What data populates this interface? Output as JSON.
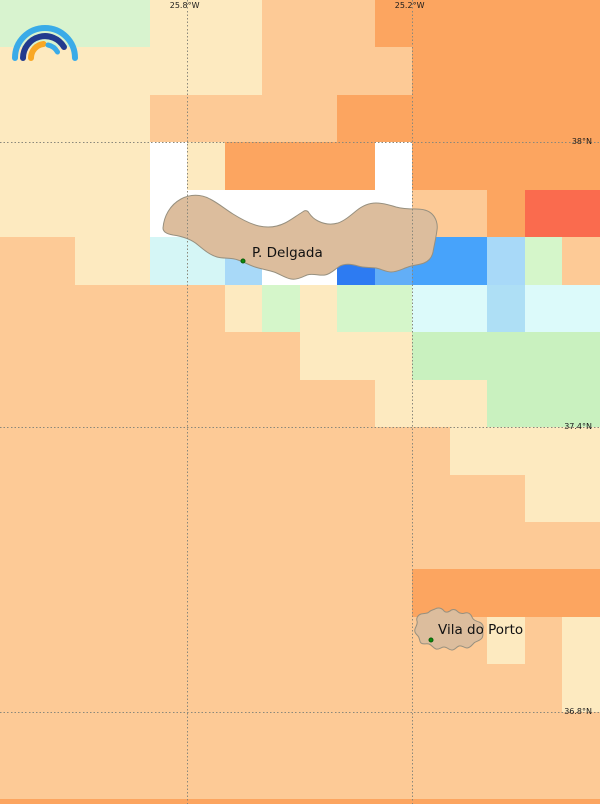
{
  "map": {
    "width": 600,
    "height": 804,
    "palette": {
      "cream": "#fdeac0",
      "peach": "#fdca96",
      "orange": "#fca560",
      "red": "#fa6b4e",
      "green": "#d8f3cf",
      "palegreen": "#d5f6ca",
      "green2": "#c9f1bf",
      "vlcyan": "#dcfafa",
      "lcyan": "#d5f6f6",
      "pblue": "#aedff5",
      "lblue": "#a8d9f8",
      "sblue": "#62aef7",
      "bblue": "#47a3fb",
      "rblue": "#2d7bf2",
      "white": "#ffffff",
      "island_fill": "#dcbd9d",
      "island_stroke": "#97907f"
    },
    "cells": [
      {
        "x": 0,
        "y": 0,
        "w": 600,
        "h": 804,
        "c": "peach"
      },
      {
        "x": 0,
        "y": 0,
        "w": 150,
        "h": 47,
        "c": "green"
      },
      {
        "x": 150,
        "y": 0,
        "w": 112,
        "h": 47,
        "c": "cream"
      },
      {
        "x": 0,
        "y": 47,
        "w": 262,
        "h": 48,
        "c": "cream"
      },
      {
        "x": 0,
        "y": 95,
        "w": 150,
        "h": 47,
        "c": "cream"
      },
      {
        "x": 375,
        "y": 0,
        "w": 37,
        "h": 47,
        "c": "orange"
      },
      {
        "x": 412,
        "y": 0,
        "w": 188,
        "h": 142,
        "c": "orange"
      },
      {
        "x": 337,
        "y": 95,
        "w": 75,
        "h": 47,
        "c": "orange"
      },
      {
        "x": 0,
        "y": 142,
        "w": 150,
        "h": 95,
        "c": "cream"
      },
      {
        "x": 150,
        "y": 142,
        "w": 37,
        "h": 95,
        "c": "white"
      },
      {
        "x": 187,
        "y": 142,
        "w": 38,
        "h": 48,
        "c": "cream"
      },
      {
        "x": 225,
        "y": 142,
        "w": 150,
        "h": 48,
        "c": "orange"
      },
      {
        "x": 375,
        "y": 142,
        "w": 37,
        "h": 48,
        "c": "white"
      },
      {
        "x": 412,
        "y": 142,
        "w": 188,
        "h": 48,
        "c": "orange"
      },
      {
        "x": 187,
        "y": 190,
        "w": 225,
        "h": 47,
        "c": "white"
      },
      {
        "x": 487,
        "y": 190,
        "w": 38,
        "h": 47,
        "c": "orange"
      },
      {
        "x": 525,
        "y": 190,
        "w": 75,
        "h": 47,
        "c": "red"
      },
      {
        "x": 75,
        "y": 237,
        "w": 75,
        "h": 48,
        "c": "cream"
      },
      {
        "x": 150,
        "y": 237,
        "w": 75,
        "h": 48,
        "c": "lcyan"
      },
      {
        "x": 225,
        "y": 237,
        "w": 37,
        "h": 48,
        "c": "lblue"
      },
      {
        "x": 262,
        "y": 237,
        "w": 75,
        "h": 48,
        "c": "white"
      },
      {
        "x": 337,
        "y": 237,
        "w": 38,
        "h": 48,
        "c": "rblue"
      },
      {
        "x": 375,
        "y": 237,
        "w": 37,
        "h": 48,
        "c": "sblue"
      },
      {
        "x": 412,
        "y": 237,
        "w": 75,
        "h": 48,
        "c": "bblue"
      },
      {
        "x": 487,
        "y": 237,
        "w": 38,
        "h": 48,
        "c": "lblue"
      },
      {
        "x": 525,
        "y": 237,
        "w": 37,
        "h": 48,
        "c": "palegreen"
      },
      {
        "x": 225,
        "y": 285,
        "w": 37,
        "h": 47,
        "c": "cream"
      },
      {
        "x": 262,
        "y": 285,
        "w": 38,
        "h": 47,
        "c": "palegreen"
      },
      {
        "x": 300,
        "y": 285,
        "w": 37,
        "h": 47,
        "c": "cream"
      },
      {
        "x": 337,
        "y": 285,
        "w": 75,
        "h": 47,
        "c": "palegreen"
      },
      {
        "x": 412,
        "y": 285,
        "w": 75,
        "h": 47,
        "c": "vlcyan"
      },
      {
        "x": 487,
        "y": 285,
        "w": 38,
        "h": 47,
        "c": "pblue"
      },
      {
        "x": 525,
        "y": 285,
        "w": 75,
        "h": 47,
        "c": "vlcyan"
      },
      {
        "x": 300,
        "y": 332,
        "w": 112,
        "h": 48,
        "c": "cream"
      },
      {
        "x": 412,
        "y": 332,
        "w": 188,
        "h": 48,
        "c": "green2"
      },
      {
        "x": 375,
        "y": 380,
        "w": 112,
        "h": 47,
        "c": "cream"
      },
      {
        "x": 487,
        "y": 380,
        "w": 113,
        "h": 47,
        "c": "green2"
      },
      {
        "x": 450,
        "y": 427,
        "w": 150,
        "h": 48,
        "c": "cream"
      },
      {
        "x": 525,
        "y": 475,
        "w": 75,
        "h": 47,
        "c": "cream"
      },
      {
        "x": 412,
        "y": 569,
        "w": 188,
        "h": 48,
        "c": "orange"
      },
      {
        "x": 487,
        "y": 617,
        "w": 38,
        "h": 47,
        "c": "cream"
      },
      {
        "x": 562,
        "y": 617,
        "w": 38,
        "h": 95,
        "c": "cream"
      },
      {
        "x": 0,
        "y": 799,
        "w": 600,
        "h": 5,
        "c": "orange"
      }
    ],
    "graticule": {
      "color": "#8a887b",
      "verticals": [
        {
          "x": 187,
          "label": "25.8°W"
        },
        {
          "x": 412,
          "label": "25.2°W"
        }
      ],
      "horizontals": [
        {
          "y": 142,
          "label": "38°N"
        },
        {
          "y": 427,
          "label": "37.4°N"
        },
        {
          "y": 712,
          "label": "36.8°N"
        }
      ]
    },
    "islands": {
      "sao_miguel": "M 163 228 C 164 216 170 205 181 199 C 190 194 201 194 210 199 C 218 203 225 209 233 214 C 241 219 250 224 259 226 C 268 228 277 227 285 223 C 291 220 296 216 301 213 L 304 211 C 306 210 308 211 309 213 C 311 216 314 219 318 221 C 324 224 331 225 338 223 C 344 221 350 216 356 211 C 362 206 369 203 376 203 C 383 203 390 205 396 207 C 403 209 410 209 416 209 C 422 209 428 210 432 214 C 436 218 438 224 437 230 C 436 238 434 246 433 252 C 432 257 429 261 424 263 C 419 265 413 265 408 267 C 402 269 397 272 391 272 C 386 272 381 269 376 268 C 370 267 364 268 358 266 C 352 264 346 263 340 266 C 335 269 331 274 325 275 C 319 276 313 273 307 275 C 302 277 297 280 291 279 C 285 278 280 274 274 272 C 268 270 261 269 255 267 C 249 265 244 262 238 260 C 231 257 224 259 217 257 C 210 255 204 250 198 245 C 190 238 180 236 173 235 C 167 234 163 232 163 228 Z",
      "santa_maria": "M 435 609 C 438 607 442 608 444 611 C 446 613 448 612 450 611 C 452 609 455 609 457 611 C 459 613 462 614 465 613 C 468 612 471 614 472 617 C 473 620 476 621 479 622 C 482 623 484 626 483 629 C 482 632 484 635 482 638 C 480 641 476 641 474 643 C 472 645 470 648 467 648 C 464 648 462 645 459 646 C 456 647 455 650 452 650 C 449 650 447 647 444 647 C 441 647 439 650 436 649 C 433 648 432 645 429 644 C 426 643 423 645 421 643 C 419 641 420 638 418 636 C 416 634 414 632 415 629 C 416 626 418 624 417 621 C 416 618 418 615 421 614 C 424 613 427 614 429 612 C 431 610 433 610 435 609 Z"
    },
    "cities": [
      {
        "name": "P. Delgada",
        "dot_x": 243,
        "dot_y": 261,
        "text_x": 252,
        "text_y": 245
      },
      {
        "name": "Vila do Porto",
        "dot_x": 431,
        "dot_y": 640,
        "text_x": 438,
        "text_y": 622
      }
    ],
    "logo": {
      "outer_arc": "#3aabe8",
      "middle_arc": "#223a8e",
      "inner_arc": "#f9a825",
      "accent_arc": "#3aabe8"
    }
  }
}
